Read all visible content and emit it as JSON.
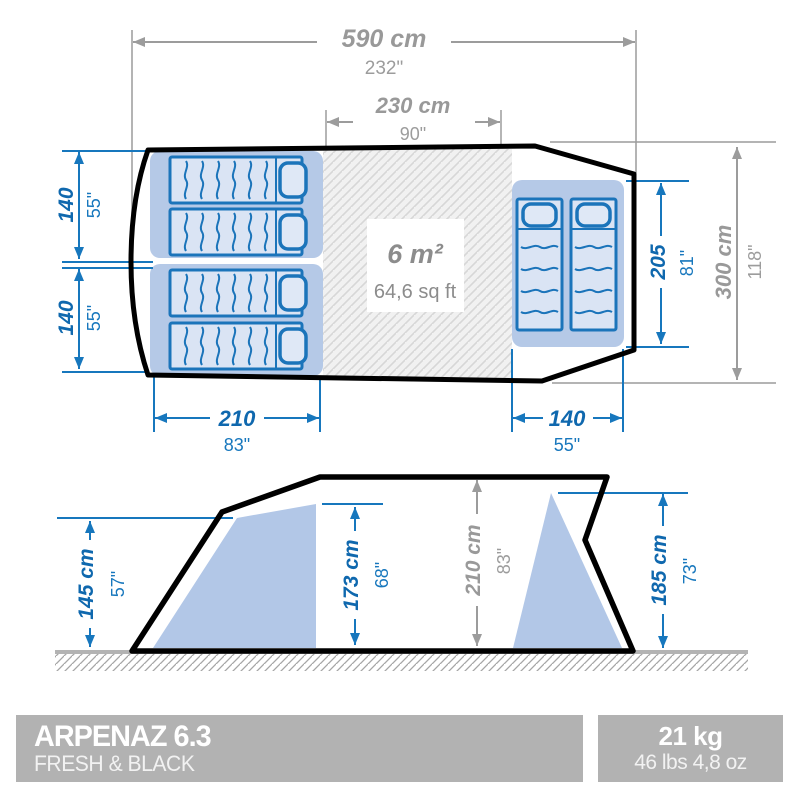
{
  "plan": {
    "total_width": {
      "metric": "590 cm",
      "imperial": "232\""
    },
    "living_width": {
      "metric": "230 cm",
      "imperial": "90\""
    },
    "bedroom_left_depth_top": {
      "metric": "140",
      "imperial": "55\""
    },
    "bedroom_left_depth_bottom": {
      "metric": "140",
      "imperial": "55\""
    },
    "bedroom_left_width": {
      "metric": "210",
      "imperial": "83\""
    },
    "bedroom_right_width": {
      "metric": "140",
      "imperial": "55\""
    },
    "bedroom_right_length": {
      "metric": "205",
      "imperial": "81\""
    },
    "total_depth": {
      "metric": "300 cm",
      "imperial": "118\""
    },
    "living_area": {
      "metric": "6 m²",
      "imperial": "64,6 sq ft"
    }
  },
  "side": {
    "height_bedroom_left": {
      "metric": "145 cm",
      "imperial": "57\""
    },
    "height_door": {
      "metric": "173 cm",
      "imperial": "68\""
    },
    "height_peak": {
      "metric": "210 cm",
      "imperial": "83\""
    },
    "height_rear": {
      "metric": "185 cm",
      "imperial": "73\""
    }
  },
  "footer": {
    "product_name": "ARPENAZ 6.3",
    "product_variant": "FRESH & BLACK",
    "weight_metric": "21 kg",
    "weight_imperial": "46 lbs 4,8 oz"
  },
  "colors": {
    "dimension_blue": "#1777bd",
    "text_blue": "#0f68ae",
    "dimension_gray": "#9c9c9c",
    "bedroom_fill": "#b5c9e7",
    "mattress_fill": "#dae4f4",
    "outline_black": "#000000",
    "footer_gray": "#b2b2b2"
  }
}
